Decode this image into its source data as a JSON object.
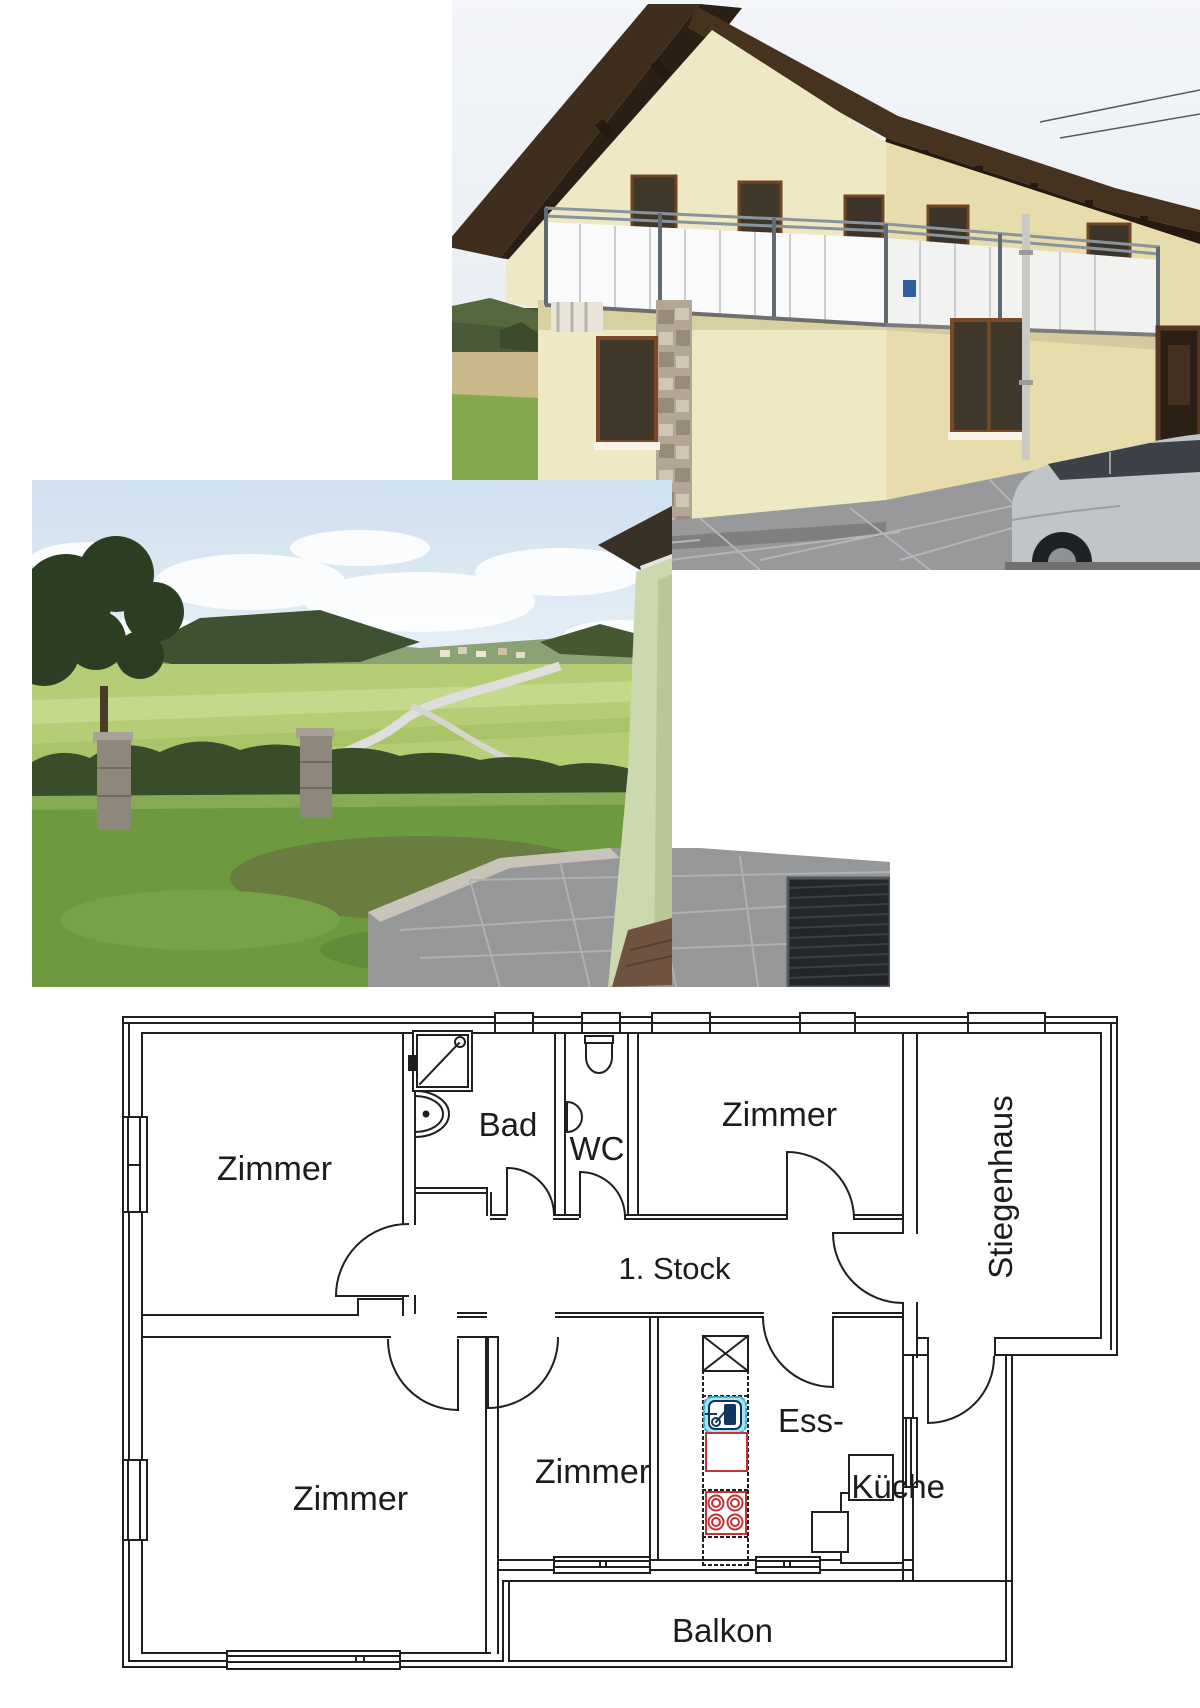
{
  "page": {
    "type": "real-estate-collage",
    "background": "#ffffff"
  },
  "photos": {
    "house": {
      "label": "house-exterior-photo",
      "palette": {
        "sky": "#eef2f6",
        "roof": "#3f2e1d",
        "wall_front": "#efe8c4",
        "wall_side": "#e7dcab",
        "balcony_panel": "#fafafa",
        "stone_pillar": "#b3a694",
        "pavement": "#98999b",
        "car": "#c2c5c8"
      }
    },
    "garden": {
      "label": "garden-view-photo",
      "palette": {
        "sky": "#d9e6f2",
        "woods": "#3e5130",
        "meadow": "#b5cd74",
        "lawn": "#6e9a3f",
        "terrace": "#969799",
        "house_corner": "#ccd8ae"
      }
    }
  },
  "floor_plan": {
    "labels": {
      "room_top_left": "Zimmer",
      "bathroom": "Bad",
      "toilet": "WC",
      "room_top_right": "Zimmer",
      "staircase": "Stiegenhaus",
      "floor": "1. Stock",
      "room_bottom_left": "Zimmer",
      "room_bottom_middle": "Zimmer",
      "kitchen_line1": "Ess-",
      "kitchen_line2": "Küche",
      "balcony": "Balkon"
    },
    "colors": {
      "line": "#1f1f1f",
      "stove_red": "#c43333",
      "sink_blue_dark": "#10355e",
      "sink_blue_light": "#aee0f0"
    }
  }
}
